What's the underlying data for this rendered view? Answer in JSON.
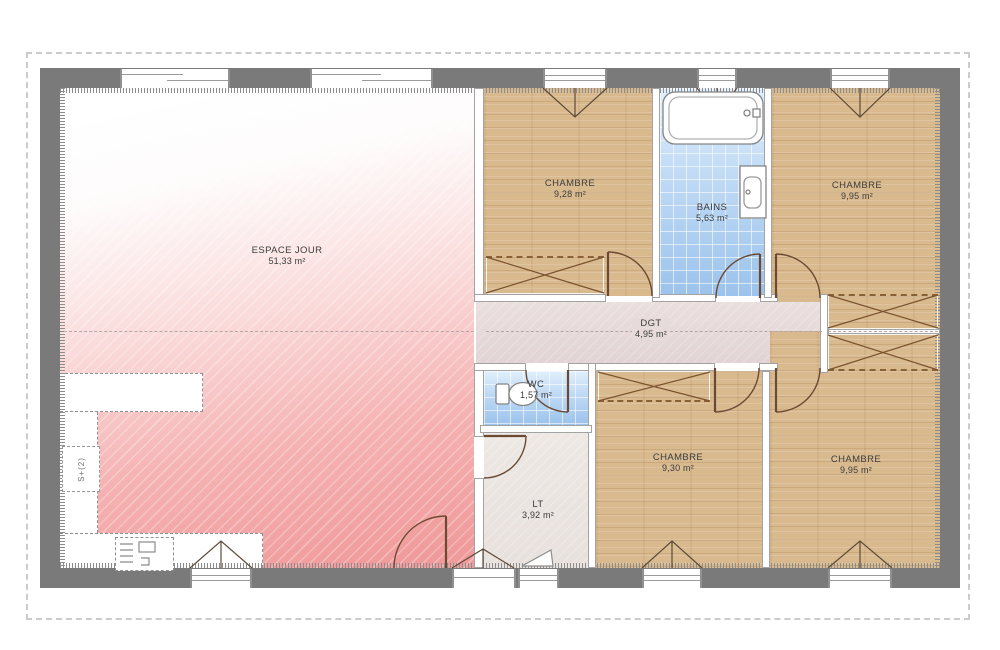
{
  "plan": {
    "title": "floor-plan",
    "rooms": [
      {
        "id": "espace-jour",
        "name": "ESPACE JOUR",
        "area": "51,33 m²"
      },
      {
        "id": "chambre-1",
        "name": "CHAMBRE",
        "area": "9,28 m²"
      },
      {
        "id": "bains",
        "name": "BAINS",
        "area": "5,63 m²"
      },
      {
        "id": "chambre-2",
        "name": "CHAMBRE",
        "area": "9,95 m²"
      },
      {
        "id": "dgt",
        "name": "DGT",
        "area": "4,95 m²"
      },
      {
        "id": "wc",
        "name": "WC",
        "area": "1,57 m²"
      },
      {
        "id": "chambre-3",
        "name": "CHAMBRE",
        "area": "9,30 m²"
      },
      {
        "id": "chambre-4",
        "name": "CHAMBRE",
        "area": "9,95 m²"
      },
      {
        "id": "lt",
        "name": "LT",
        "area": "3,92 m²"
      }
    ],
    "annotations": {
      "stair_note": "S+(2)"
    },
    "colors": {
      "exterior_wall": "#7a7a7a",
      "wood_floor": "#d9ba8e",
      "bath_tile": "#9cc3ec",
      "corridor_floor": "#e2d4d4",
      "living_pink": "#f09b9b",
      "lt_floor": "#e8e1dd",
      "roof_dash": "#cbcbcb",
      "fixture_line": "#6b4a35"
    }
  }
}
